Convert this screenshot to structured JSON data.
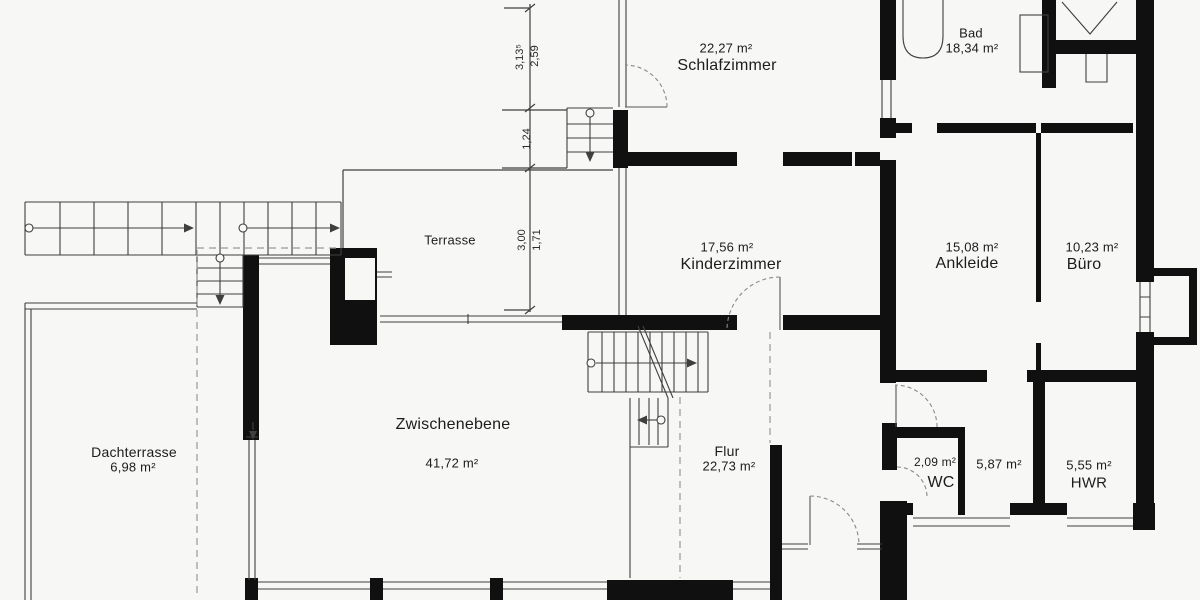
{
  "colors": {
    "wall": "#101010",
    "line": "#3f3f3f",
    "dash": "#8a8a8a",
    "background": "#f7f7f5"
  },
  "rooms": [
    {
      "id": "schlafzimmer",
      "area": {
        "text": "22,27 m²",
        "x": 726,
        "y": 48,
        "size": 13
      },
      "name": {
        "text": "Schlafzimmer",
        "x": 727,
        "y": 66,
        "size": 16
      }
    },
    {
      "id": "bad",
      "name": {
        "text": "Bad",
        "x": 971,
        "y": 33,
        "size": 13
      },
      "area": {
        "text": "18,34 m²",
        "x": 972,
        "y": 48,
        "size": 13
      }
    },
    {
      "id": "terrasse",
      "name": {
        "text": "Terrasse",
        "x": 450,
        "y": 240,
        "size": 13
      }
    },
    {
      "id": "kinderzimmer",
      "area": {
        "text": "17,56 m²",
        "x": 727,
        "y": 247,
        "size": 13
      },
      "name": {
        "text": "Kinderzimmer",
        "x": 731,
        "y": 265,
        "size": 16
      }
    },
    {
      "id": "ankleide",
      "area": {
        "text": "15,08 m²",
        "x": 972,
        "y": 247,
        "size": 13
      },
      "name": {
        "text": "Ankleide",
        "x": 967,
        "y": 264,
        "size": 16
      }
    },
    {
      "id": "buero",
      "area": {
        "text": "10,23 m²",
        "x": 1092,
        "y": 247,
        "size": 13
      },
      "name": {
        "text": "Büro",
        "x": 1084,
        "y": 265,
        "size": 16
      }
    },
    {
      "id": "dachterrasse",
      "name": {
        "text": "Dachterrasse",
        "x": 134,
        "y": 452,
        "size": 14
      },
      "area": {
        "text": "6,98 m²",
        "x": 133,
        "y": 467,
        "size": 13
      }
    },
    {
      "id": "zwischenebene",
      "name": {
        "text": "Zwischenebene",
        "x": 453,
        "y": 425,
        "size": 16
      },
      "area": {
        "text": "41,72 m²",
        "x": 452,
        "y": 463,
        "size": 13
      }
    },
    {
      "id": "flur",
      "name": {
        "text": "Flur",
        "x": 727,
        "y": 451,
        "size": 14
      },
      "area": {
        "text": "22,73 m²",
        "x": 729,
        "y": 466,
        "size": 13
      }
    },
    {
      "id": "wc",
      "area": {
        "text": "2,09 m²",
        "x": 935,
        "y": 462,
        "size": 12
      },
      "name": {
        "text": "WC",
        "x": 941,
        "y": 483,
        "size": 16
      }
    },
    {
      "id": "raum-587",
      "area": {
        "text": "5,87 m²",
        "x": 999,
        "y": 464,
        "size": 13
      }
    },
    {
      "id": "hwr",
      "area": {
        "text": "5,55 m²",
        "x": 1089,
        "y": 465,
        "size": 13
      },
      "name": {
        "text": "HWR",
        "x": 1089,
        "y": 483,
        "size": 15
      }
    }
  ],
  "dims": [
    {
      "text": "3,13⁵",
      "x": 520,
      "y": 57
    },
    {
      "text": "2,59",
      "x": 535,
      "y": 56
    },
    {
      "text": "1,24",
      "x": 527,
      "y": 139
    },
    {
      "text": "3,00",
      "x": 522,
      "y": 240
    },
    {
      "text": "1,71",
      "x": 537,
      "y": 240
    }
  ]
}
